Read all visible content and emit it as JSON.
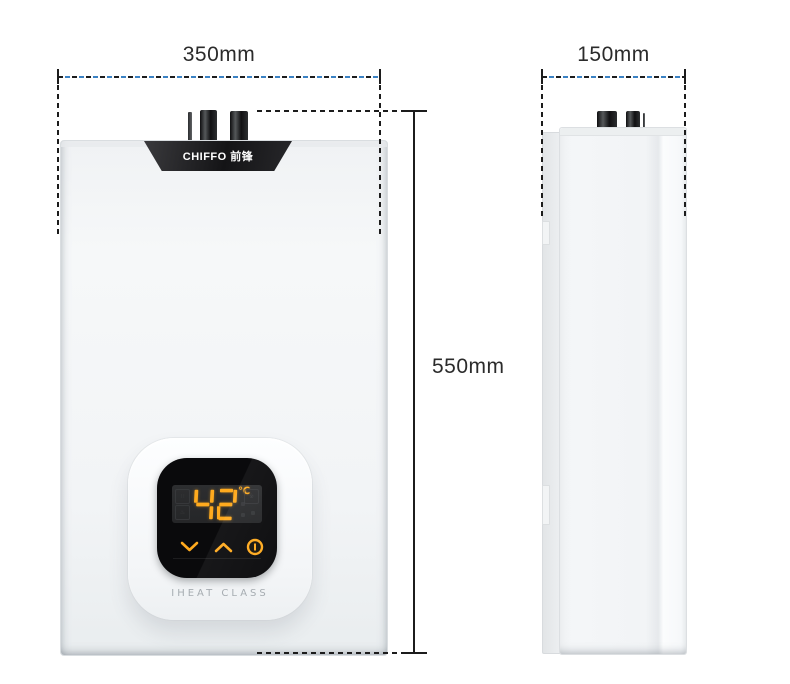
{
  "dimensions": {
    "width_label": "350mm",
    "depth_label": "150mm",
    "height_label": "550mm"
  },
  "heater": {
    "brand_logo": "CHIFFO 前锋",
    "display": {
      "temperature": "42",
      "unit": "℃"
    },
    "series_label": "IHEAT CLASS"
  },
  "colors": {
    "display_accent": "#ffaa1e",
    "dim_dash_blue": "#3b82c4",
    "dim_dark": "#1c1c1c",
    "screen_black": "#0a0a0c"
  }
}
